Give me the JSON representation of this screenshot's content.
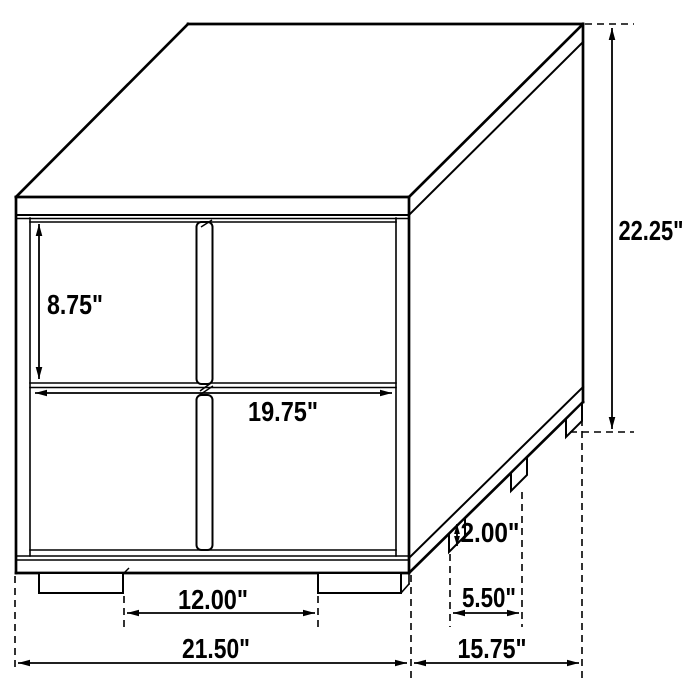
{
  "diagram": {
    "kind": "furniture-dimension-line-drawing",
    "unit": "inches",
    "colors": {
      "line": "#000000",
      "background": "#ffffff",
      "text": "#000000"
    },
    "dimensions": {
      "overall_height": {
        "label": "22.25\"",
        "inches": 22.25
      },
      "drawer_face_height": {
        "label": "8.75\"",
        "inches": 8.75
      },
      "drawer_width": {
        "label": "19.75\"",
        "inches": 19.75
      },
      "leg_height": {
        "label": "2.00\"",
        "inches": 2.0
      },
      "front_leg_spacing": {
        "label": "12.00\"",
        "inches": 12.0
      },
      "side_leg_spacing": {
        "label": "5.50\"",
        "inches": 5.5
      },
      "overall_width": {
        "label": "21.50\"",
        "inches": 21.5
      },
      "overall_depth": {
        "label": "15.75\"",
        "inches": 15.75
      }
    }
  }
}
